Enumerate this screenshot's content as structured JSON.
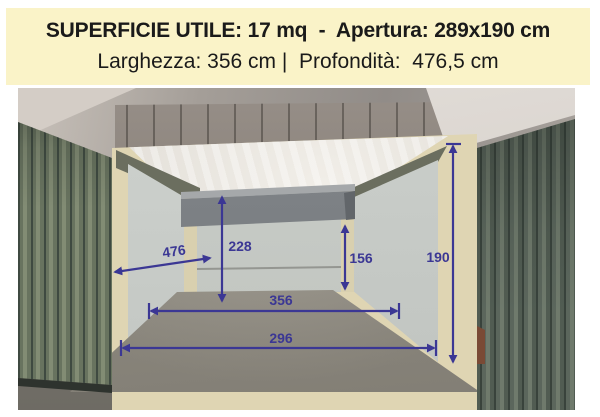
{
  "header": {
    "line1": "SUPERFICIE UTILE: 17 mq  -  Apertura: 289x190 cm",
    "line2": "Larghezza: 356 cm |  Profondità:  476,5 cm",
    "background_color": "#FAF3C8",
    "text_color": "#1A1A1A"
  },
  "photo": {
    "annotation_color": "#3B3794",
    "measurements": {
      "depth": "476",
      "ceiling_height": "228",
      "under_beam_height": "156",
      "opening_height": "190",
      "interior_width": "356",
      "opening_width": "296"
    }
  }
}
